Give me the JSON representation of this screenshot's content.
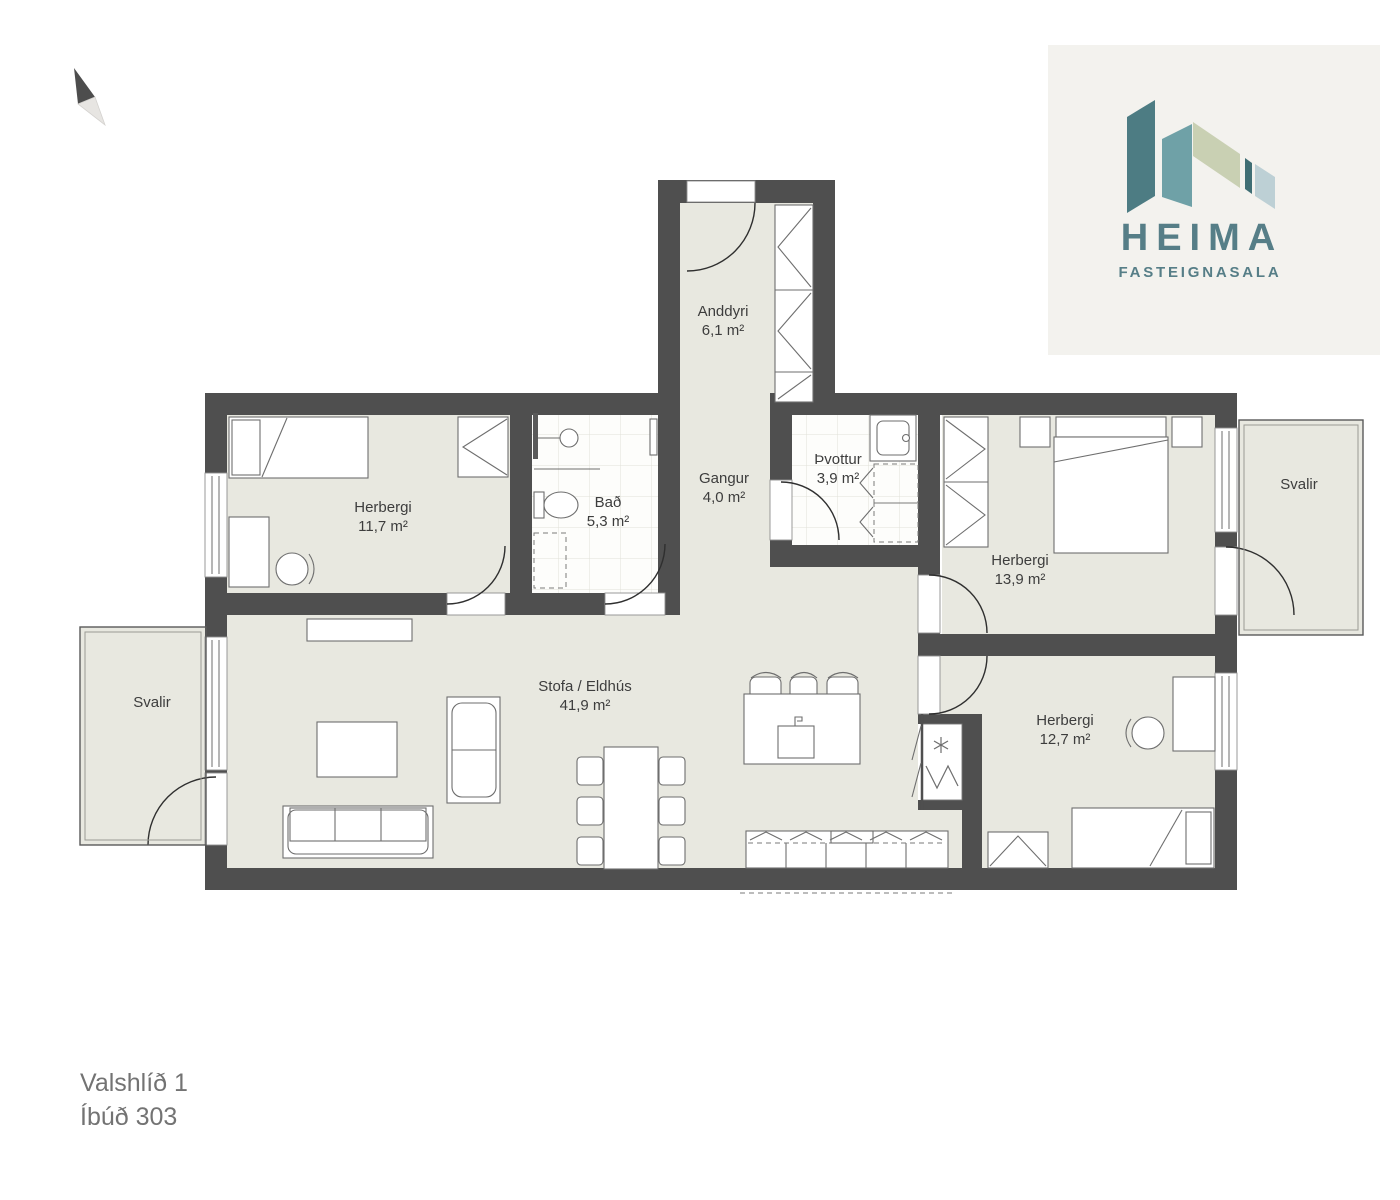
{
  "page": {
    "background": "#ffffff"
  },
  "logo": {
    "brand": "HEIMA",
    "tagline": "FASTEIGNASALA",
    "background_color": "#f3f2ee",
    "text_color": "#567e87",
    "glyph_colors": [
      "#4d7c83",
      "#6fa1a7",
      "#c9d0b3",
      "#3f6e74",
      "#bdd0d5"
    ]
  },
  "floor_plan": {
    "wall_color": "#4f4f4f",
    "floor_color": "#e8e8e0",
    "tile_color": "#fdfdfb",
    "label_color": "#3d3d3d",
    "rooms": [
      {
        "id": "anddyri",
        "name": "Anddyri",
        "area": "6,1 m²"
      },
      {
        "id": "herbergi-nw",
        "name": "Herbergi",
        "area": "11,7 m²"
      },
      {
        "id": "bad",
        "name": "Bað",
        "area": "5,3 m²"
      },
      {
        "id": "gangur",
        "name": "Gangur",
        "area": "4,0 m²"
      },
      {
        "id": "thvottur",
        "name": "Þvottur",
        "area": "3,9 m²"
      },
      {
        "id": "herbergi-ne",
        "name": "Herbergi",
        "area": "13,9 m²"
      },
      {
        "id": "svalir-east",
        "name": "Svalir",
        "area": ""
      },
      {
        "id": "stofa-eldhus",
        "name": "Stofa / Eldhús",
        "area": "41,9 m²"
      },
      {
        "id": "herbergi-se",
        "name": "Herbergi",
        "area": "12,7 m²"
      },
      {
        "id": "svalir-west",
        "name": "Svalir",
        "area": ""
      }
    ]
  },
  "footer": {
    "address": "Valshlíð 1",
    "unit": "Íbúð 303"
  }
}
